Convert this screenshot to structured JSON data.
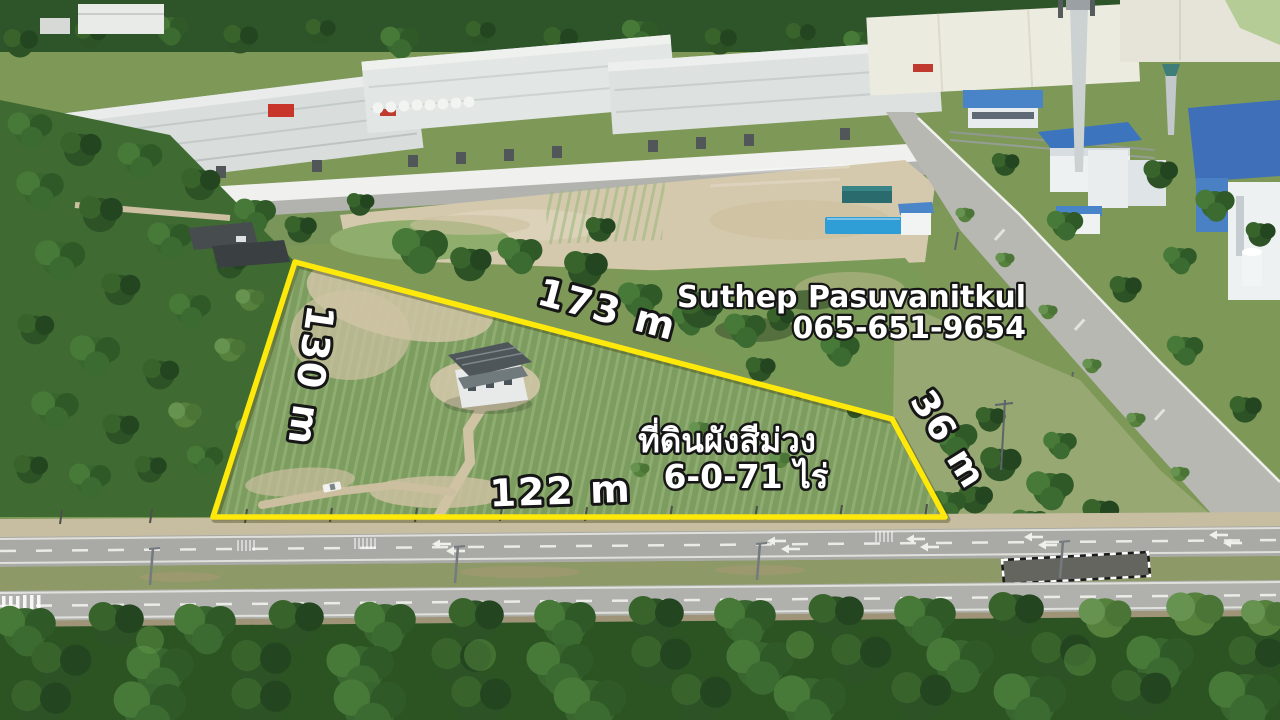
{
  "photo": {
    "type": "aerial-drone-photo",
    "subject": "vacant land plot for sale outlined in yellow beside an industrial estate road"
  },
  "overlay": {
    "contact": {
      "name": "Suthep Pasuvanitkul",
      "phone": "065-651-9654"
    },
    "measurements": {
      "top_side": "173 m",
      "left_side": "130 m",
      "bottom_side": "122 m",
      "right_side": "36 m"
    },
    "plot_info": {
      "zoning_line": "ที่ดินผังสีม่วง",
      "area_line": "6-0-71 ไร่"
    },
    "colors": {
      "boundary": "#ffe90a",
      "label_text": "#ffffff",
      "label_outline": "#161616"
    }
  }
}
